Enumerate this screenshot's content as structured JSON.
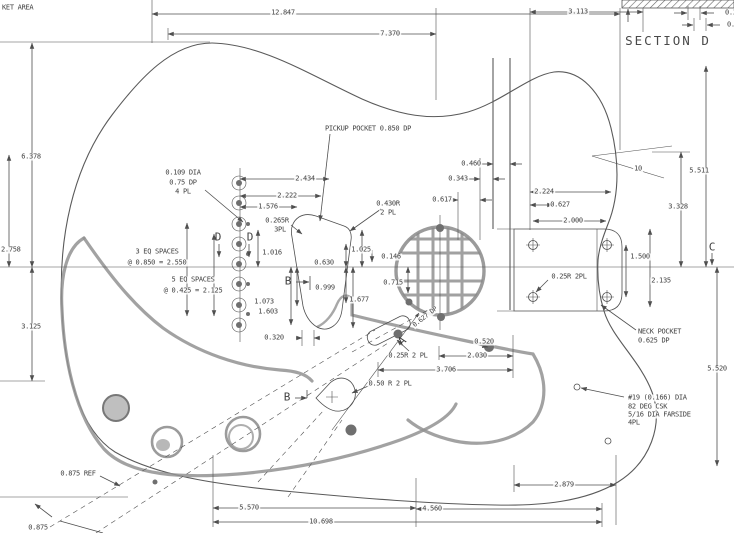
{
  "colors": {
    "background": "#ffffff",
    "line_color": "#4f4f4f",
    "text_color": "#3f3f3f",
    "pickguard_color": "#929292"
  },
  "drawing": {
    "type": "engineering-drawing",
    "subject": "guitar body with routing pockets, neck pocket and hole locations"
  },
  "labels": [
    {
      "n": "pocket-area-note",
      "t": "KET AREA",
      "x": 1,
      "y": 8,
      "a": "left"
    },
    {
      "n": "dim-12847",
      "t": "12.847",
      "x": 283,
      "y": 13
    },
    {
      "n": "dim-3113",
      "t": "3.113",
      "x": 578,
      "y": 12
    },
    {
      "n": "dim-7370",
      "t": "7.370",
      "x": 390,
      "y": 34
    },
    {
      "n": "dim-section-a",
      "t": "0.3",
      "x": 724,
      "y": 13,
      "a": "left"
    },
    {
      "n": "dim-section-b",
      "t": "0.3",
      "x": 726,
      "y": 25,
      "a": "left"
    },
    {
      "n": "section-title",
      "t": "SECTION D",
      "x": 668,
      "y": 41,
      "cls": "big"
    },
    {
      "n": "dim-6378",
      "t": "6.378",
      "x": 31,
      "y": 157
    },
    {
      "n": "dim-2758",
      "t": "2.758",
      "x": 0,
      "y": 250,
      "a": "left"
    },
    {
      "n": "dim-3125",
      "t": "3.125",
      "x": 31,
      "y": 327
    },
    {
      "n": "note-ferrule-dia",
      "t": "0.109 DIA",
      "x": 183,
      "y": 173
    },
    {
      "n": "note-ferrule-dp",
      "t": "0.75 DP",
      "x": 183,
      "y": 183
    },
    {
      "n": "note-ferrule-pl",
      "t": "4 PL",
      "x": 183,
      "y": 192
    },
    {
      "n": "dim-2434",
      "t": "2.434",
      "x": 305,
      "y": 179
    },
    {
      "n": "dim-2222",
      "t": "2.222",
      "x": 287,
      "y": 196
    },
    {
      "n": "dim-1576",
      "t": "1.576",
      "x": 268,
      "y": 207
    },
    {
      "n": "note-0265r",
      "t": "0.265R",
      "x": 277,
      "y": 221
    },
    {
      "n": "note-0265r-pl",
      "t": "3PL",
      "x": 280,
      "y": 230
    },
    {
      "n": "marker-d-left",
      "t": "D",
      "x": 218,
      "y": 237,
      "cls": "marker"
    },
    {
      "n": "marker-d-right",
      "t": "D",
      "x": 250,
      "y": 237,
      "cls": "marker"
    },
    {
      "n": "dim-1016",
      "t": "1.016",
      "x": 272,
      "y": 253
    },
    {
      "n": "note-3eq-1",
      "t": "3 EQ SPACES",
      "x": 157,
      "y": 252
    },
    {
      "n": "note-3eq-2",
      "t": "@ 0.850 = 2.550",
      "x": 157,
      "y": 263
    },
    {
      "n": "note-5eq-1",
      "t": "5 EQ SPACES",
      "x": 193,
      "y": 280
    },
    {
      "n": "note-5eq-2",
      "t": "@ 0.425 = 2.125",
      "x": 193,
      "y": 291
    },
    {
      "n": "dim-1073",
      "t": "1.073",
      "x": 264,
      "y": 302
    },
    {
      "n": "dim-1603",
      "t": "1.603",
      "x": 268,
      "y": 312
    },
    {
      "n": "dim-0320",
      "t": "0.320",
      "x": 274,
      "y": 338
    },
    {
      "n": "note-pickup-pocket",
      "t": "PICKUP POCKET 0.850 DP",
      "x": 368,
      "y": 129
    },
    {
      "n": "note-0430r",
      "t": "0.430R",
      "x": 388,
      "y": 204
    },
    {
      "n": "note-0430r-pl",
      "t": "2 PL",
      "x": 388,
      "y": 213
    },
    {
      "n": "dim-0630",
      "t": "0.630",
      "x": 324,
      "y": 263
    },
    {
      "n": "marker-b-upper",
      "t": "B",
      "x": 288,
      "y": 281,
      "cls": "marker"
    },
    {
      "n": "dim-0999",
      "t": "0.999",
      "x": 325,
      "y": 288
    },
    {
      "n": "dim-1025",
      "t": "1.025",
      "x": 361,
      "y": 250
    },
    {
      "n": "dim-0146",
      "t": "0.146",
      "x": 391,
      "y": 257
    },
    {
      "n": "dim-0715",
      "t": "0.715",
      "x": 393,
      "y": 283
    },
    {
      "n": "dim-1677",
      "t": "1.677",
      "x": 359,
      "y": 300
    },
    {
      "n": "dim-0460",
      "t": "0.460",
      "x": 471,
      "y": 164
    },
    {
      "n": "dim-0343",
      "t": "0.343",
      "x": 458,
      "y": 179
    },
    {
      "n": "dim-0617",
      "t": "0.617",
      "x": 442,
      "y": 200
    },
    {
      "n": "dim-2224",
      "t": "2.224",
      "x": 544,
      "y": 192
    },
    {
      "n": "dim-0627",
      "t": "0.627",
      "x": 560,
      "y": 205
    },
    {
      "n": "dim-2000",
      "t": "2.000",
      "x": 573,
      "y": 221
    },
    {
      "n": "dim-1500",
      "t": "1.500",
      "x": 640,
      "y": 257
    },
    {
      "n": "dim-2135",
      "t": "2.135",
      "x": 661,
      "y": 281
    },
    {
      "n": "note-025r-neck",
      "t": "0.25R 2PL",
      "x": 569,
      "y": 277
    },
    {
      "n": "note-neck-pocket-1",
      "t": "NECK POCKET",
      "x": 637,
      "y": 332,
      "a": "left"
    },
    {
      "n": "note-neck-pocket-2",
      "t": "0.625 DP",
      "x": 637,
      "y": 341,
      "a": "left"
    },
    {
      "n": "marker-c",
      "t": "C",
      "x": 712,
      "y": 247,
      "cls": "marker"
    },
    {
      "n": "dim-10deg",
      "t": "10",
      "x": 638,
      "y": 169
    },
    {
      "n": "dim-5511",
      "t": "5.511",
      "x": 699,
      "y": 171
    },
    {
      "n": "dim-3328",
      "t": "3.328",
      "x": 678,
      "y": 207
    },
    {
      "n": "dim-5520",
      "t": "5.520",
      "x": 717,
      "y": 369
    },
    {
      "n": "note-hole19-1",
      "t": "#19 (0.166) DIA",
      "x": 627,
      "y": 398,
      "a": "left"
    },
    {
      "n": "note-hole19-2",
      "t": "82 DEG CSK",
      "x": 627,
      "y": 407,
      "a": "left"
    },
    {
      "n": "note-hole19-3",
      "t": "5/16 DIA FARSIDE",
      "x": 627,
      "y": 415,
      "a": "left"
    },
    {
      "n": "note-hole19-4",
      "t": "4PL",
      "x": 627,
      "y": 423,
      "a": "left"
    },
    {
      "n": "dim-2879",
      "t": "2.879",
      "x": 564,
      "y": 485
    },
    {
      "n": "note-025r-bridge",
      "t": "0.25R 2 PL",
      "x": 408,
      "y": 356
    },
    {
      "n": "dim-2030",
      "t": "2.030",
      "x": 477,
      "y": 356
    },
    {
      "n": "dim-3706",
      "t": "3.706",
      "x": 446,
      "y": 370
    },
    {
      "n": "dim-0520",
      "t": "0.520",
      "x": 484,
      "y": 342
    },
    {
      "n": "note-050r",
      "t": "0.50 R 2 PL",
      "x": 390,
      "y": 384
    },
    {
      "n": "marker-b-lower",
      "t": "B",
      "x": 287,
      "y": 397,
      "cls": "marker"
    },
    {
      "n": "marker-a",
      "t": "A",
      "x": 402,
      "y": 341,
      "cls": "marker",
      "r": -40
    },
    {
      "n": "note-a-depth",
      "t": "0.627 DP",
      "x": 425,
      "y": 317,
      "r": -38,
      "fs": 6.5
    },
    {
      "n": "note-0875ref",
      "t": "0.875 REF",
      "x": 78,
      "y": 474
    },
    {
      "n": "dim-0875",
      "t": "0.875",
      "x": 38,
      "y": 528
    },
    {
      "n": "dim-5570",
      "t": "5.570",
      "x": 249,
      "y": 508
    },
    {
      "n": "dim-10698",
      "t": "10.698",
      "x": 321,
      "y": 522
    },
    {
      "n": "dim-4560",
      "t": "4.560",
      "x": 432,
      "y": 509
    }
  ]
}
